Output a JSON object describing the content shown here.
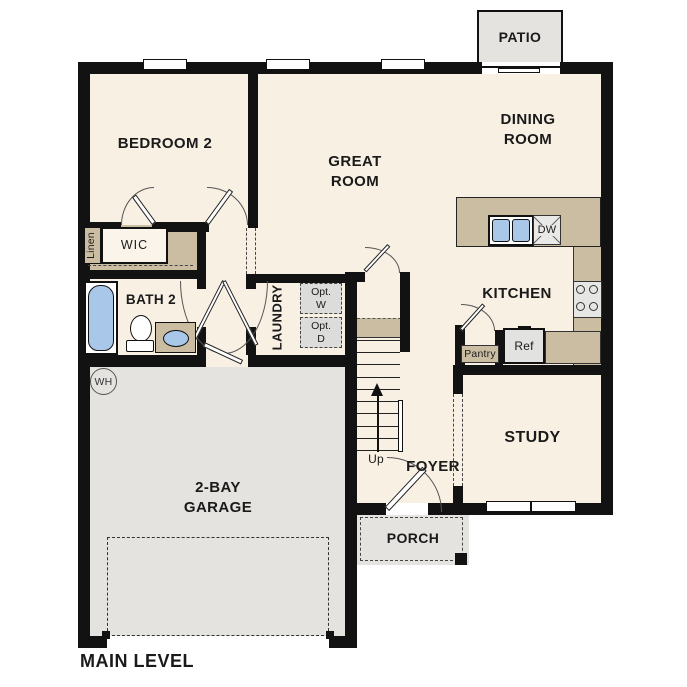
{
  "plan": {
    "title": "MAIN LEVEL"
  },
  "rooms": {
    "patio": "PATIO",
    "bedroom2": "BEDROOM 2",
    "great_room_line1": "GREAT",
    "great_room_line2": "ROOM",
    "dining_room_line1": "DINING",
    "dining_room_line2": "ROOM",
    "kitchen": "KITCHEN",
    "bath2": "BATH 2",
    "wic": "WIC",
    "linen": "Linen",
    "laundry": "LAUNDRY",
    "study": "STUDY",
    "foyer": "FOYER",
    "garage_line1": "2-BAY",
    "garage_line2": "GARAGE",
    "porch": "PORCH"
  },
  "annotations": {
    "opt_washer_line1": "Opt.",
    "opt_washer_line2": "W",
    "opt_dryer_line1": "Opt.",
    "opt_dryer_line2": "D",
    "pantry": "Pantry",
    "ref": "Ref",
    "dishwasher": "DW",
    "water_heater": "WH",
    "stairs_direction": "Up"
  },
  "colors": {
    "floor_cream": "#f8f0e3",
    "counter_tan": "#cbbda2",
    "concrete_gray": "#e4e3e0",
    "fixture_blue": "#a8c7e9",
    "appliance_gray": "#dcdcda",
    "wall_black": "#121212"
  }
}
